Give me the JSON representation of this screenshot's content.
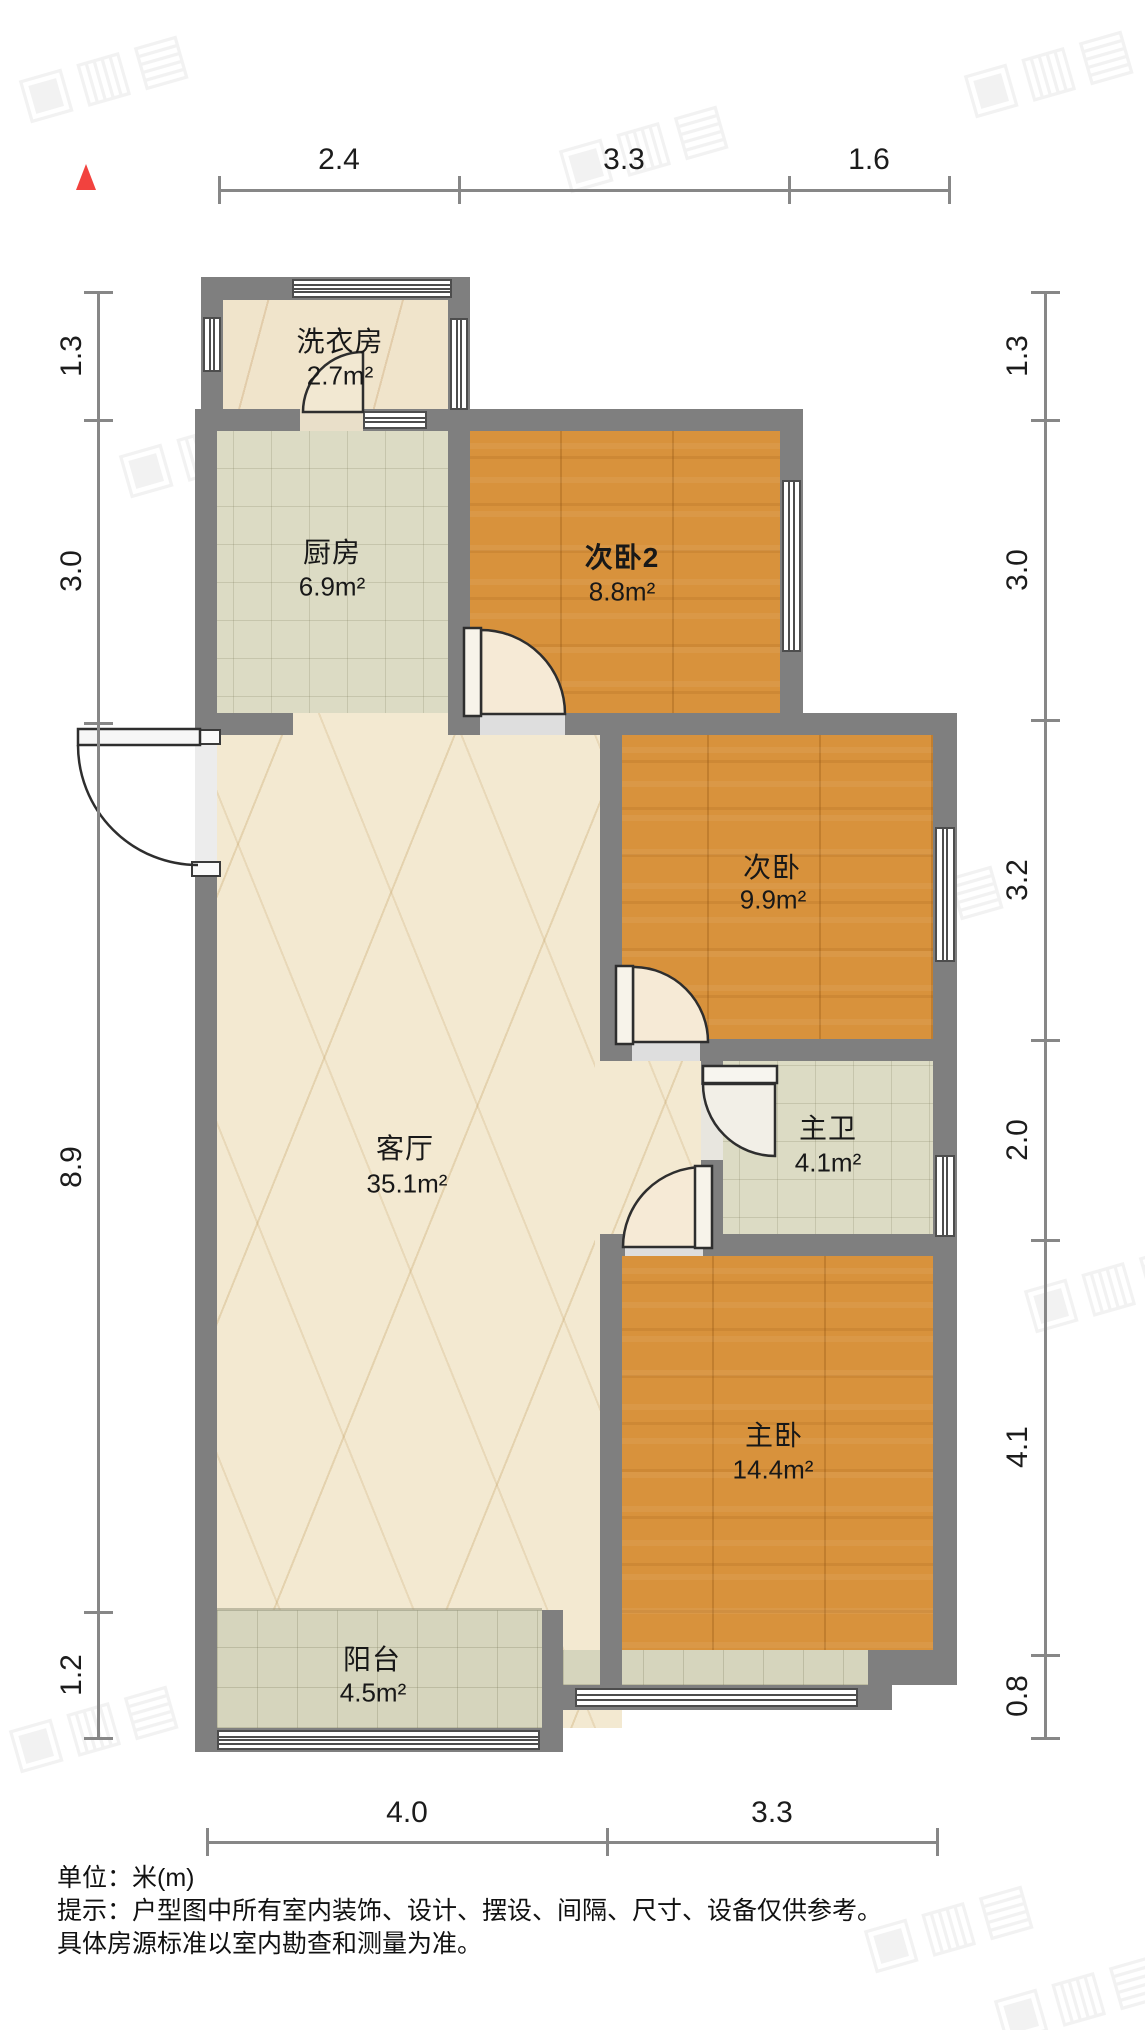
{
  "compass": {
    "description": "north-indicator-triangle",
    "color": "#f2423e"
  },
  "rooms": [
    {
      "id": "laundry",
      "name": "洗衣房",
      "area": "2.7m²"
    },
    {
      "id": "kitchen",
      "name": "厨房",
      "area": "6.9m²"
    },
    {
      "id": "bedroom2b",
      "name": "次卧2",
      "area": "8.8m²"
    },
    {
      "id": "bedroom2",
      "name": "次卧",
      "area": "9.9m²"
    },
    {
      "id": "master-bath",
      "name": "主卫",
      "area": "4.1m²"
    },
    {
      "id": "living-room",
      "name": "客厅",
      "area": "35.1m²"
    },
    {
      "id": "master-bedroom",
      "name": "主卧",
      "area": "14.4m²"
    },
    {
      "id": "balcony",
      "name": "阳台",
      "area": "4.5m²"
    }
  ],
  "dimensions": {
    "unit": "m",
    "top": [
      "2.4",
      "3.3",
      "1.6"
    ],
    "bottom": [
      "4.0",
      "3.3"
    ],
    "left": [
      "1.3",
      "3.0",
      "8.9",
      "1.2"
    ],
    "right": [
      "1.3",
      "3.0",
      "3.2",
      "2.0",
      "4.1",
      "0.8"
    ]
  },
  "footer": {
    "unit_label": "单位：米(m)",
    "notice_line1": "提示：户型图中所有室内装饰、设计、摆设、间隔、尺寸、设备仅供参考。",
    "notice_line2": "具体房源标准以室内勘查和测量为准。"
  },
  "watermark": {
    "glyphs": "▣▥▤"
  },
  "colors": {
    "wall": "#7f7f7f",
    "wood_floor": "#d8923c",
    "tile_floor": "#dcdbc4",
    "marble_floor": "#f3e9d1",
    "compass_red": "#f2423e",
    "dimension_gray": "#878787"
  }
}
